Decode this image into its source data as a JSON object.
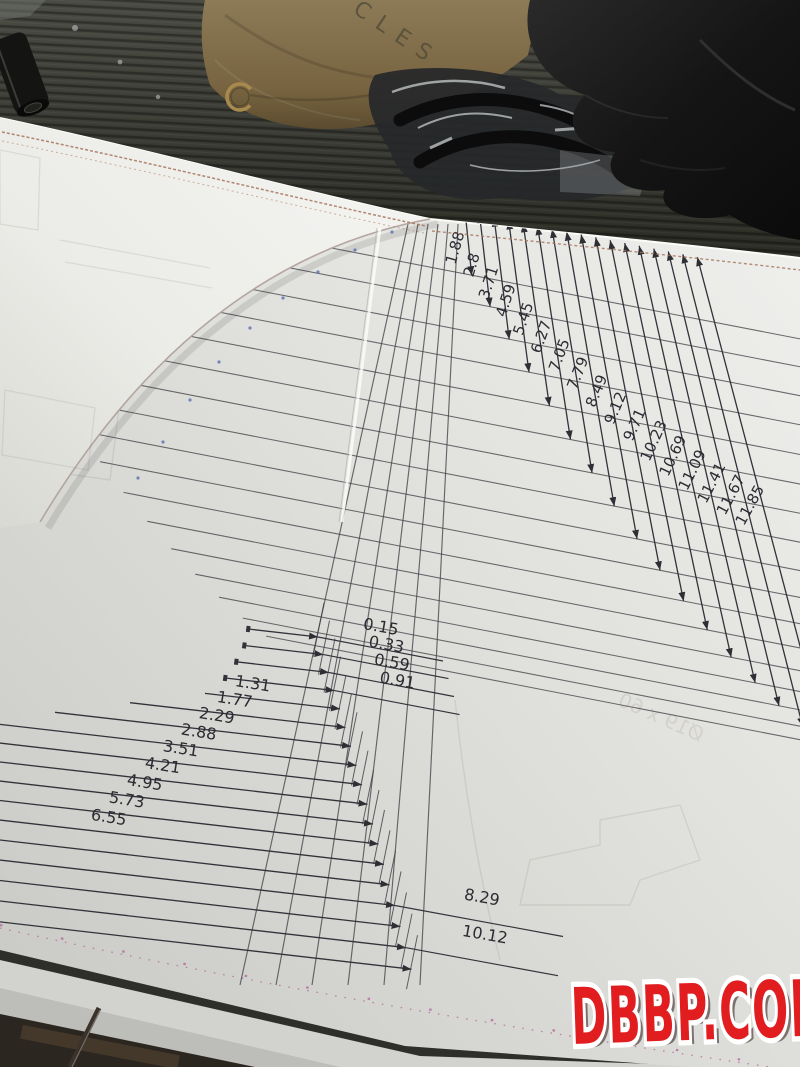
{
  "scene": {
    "watermark": {
      "text": "DBBP.COM",
      "color": "#e21d1f"
    },
    "paper_bag_stamp_text": "CLES",
    "faint_mirrored_text": "Ø19 x 60"
  },
  "drawing": {
    "type": "dimensioned_curve_template",
    "right_fan": {
      "orientation": "vertical-ordinates, labels read diagonally",
      "values": [
        1.88,
        2.8,
        3.71,
        4.59,
        5.45,
        6.27,
        7.05,
        7.79,
        8.49,
        9.12,
        9.71,
        10.23,
        10.69,
        11.09,
        11.41,
        11.67,
        11.85
      ],
      "labels": [
        "1.88",
        "2.8",
        "3.71",
        "4.59",
        "5.45",
        "6.27",
        "7.05",
        "7.79",
        "8.49",
        "9.12",
        "9.71",
        "10.23",
        "10.69",
        "11.09",
        "11.41",
        "11.67",
        "11.85"
      ]
    },
    "left_fan": {
      "orientation": "horizontal-ordinates, arrows pointing right",
      "labels": [
        "0.15",
        "0.33",
        "0.59",
        "0.91",
        "1.31",
        "1.77",
        "2.29",
        "2.88",
        "3.51",
        "4.21",
        "4.95",
        "5.73",
        "6.55",
        "",
        "8.29",
        "",
        "10.12",
        ""
      ]
    },
    "colors": {
      "paper_white": "#e9e9e6",
      "line_dark": "#32333a",
      "sepia_margin": "#a5745a",
      "pink_margin": "#b5679b",
      "curve_edge": "#b3a5a0",
      "watermark_red": "#e21d1f",
      "bench_dark": "#33342e",
      "bag_brown": "#82704f",
      "glove_black": "#161616"
    }
  }
}
